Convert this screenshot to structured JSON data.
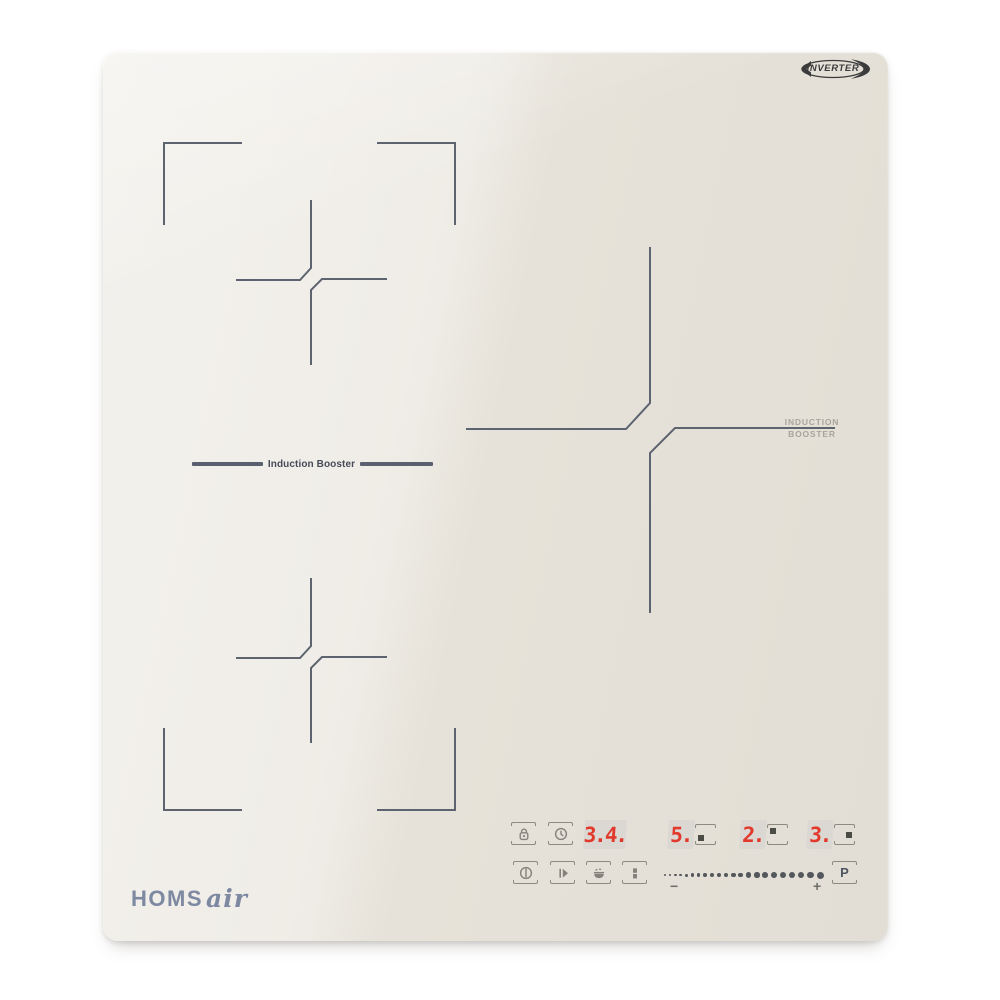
{
  "page": {
    "background": "#ffffff"
  },
  "hob": {
    "glass_color": "#e6e2d9",
    "marking_color": "#5d6470",
    "badge": {
      "label": "INVERTER",
      "color": "#3b3b3b"
    },
    "brand": {
      "word": "HOMS",
      "script": "air",
      "color": "#7d88a1"
    },
    "zone_labels": {
      "flex_divider": "Induction Booster",
      "right_zone_line1": "INDUCTION",
      "right_zone_line2": "BOOSTER"
    }
  },
  "control_panel": {
    "accent_red": "#e2392d",
    "icon_color": "#85827b",
    "row1": {
      "lock_icon": "lock-icon",
      "timer_icon": "clock-icon",
      "timer_display": "3.4.",
      "zone_displays": [
        {
          "level": "5.",
          "burner": "bottom-left"
        },
        {
          "level": "2.",
          "burner": "top-left"
        },
        {
          "level": "3.",
          "burner": "middle-right"
        }
      ]
    },
    "row2": {
      "power_icon": "power-icon",
      "start_icon": "play-icon",
      "keep_warm_icon": "keep-warm-icon",
      "bridge_icon": "pause-bridge-icon",
      "slider": {
        "minus_label": "−",
        "plus_label": "+",
        "dot_count": 22
      },
      "boost_label": "P"
    }
  }
}
